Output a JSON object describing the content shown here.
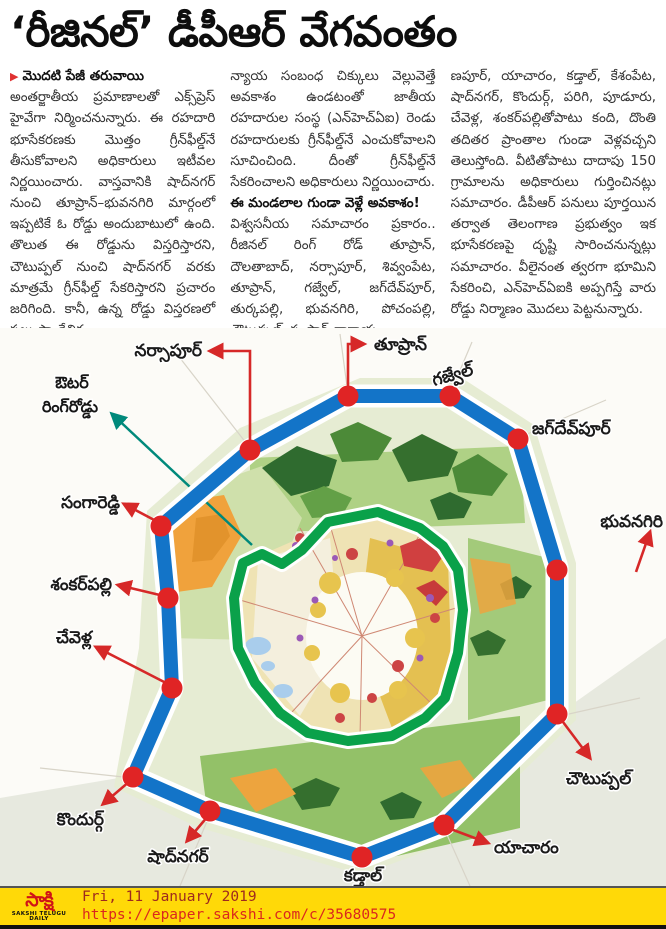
{
  "headline": "‘రీజినల్’ డీపీఆర్ వేగవంతం",
  "article": {
    "continuation_marker": "▶",
    "continuation_label": "మొదటి పేజీ తరువాయి",
    "col1": "అంతర్జాతీయ ప్రమాణాలతో ఎక్స్‌ప్రెస్ హైవేగా నిర్మించనున్నారు. ఈ రహదారి భూసేకరణకు మొత్తం గ్రీన్‌ఫీల్డ్‌నే తీసుకోవాలని అధికారులు ఇటీవల నిర్ణయించారు. వాస్తవానికి షాద్‌నగర్ నుంచి తూప్రాన్‌–భువనగిరి మార్గంలో ఇప్పటికే ఓ రోడ్డు అందుబాటులో ఉంది. తొలుత ఈ రోడ్డును విస్తరిస్తారని, చౌటుప్పల్ నుంచి షాద్‌నగర్ వరకు మాత్రమే గ్రీన్‌ఫీల్డ్ సేకరిస్తారని ప్రచారం జరిగింది. కానీ, ఉన్న రోడ్డు విస్తరణలో పలు సాంకేతిక,",
    "col2_para1": "న్యాయ సంబంధ చిక్కులు వెల్లువెత్తే అవకాశం ఉండటంతో జాతీయ రహదారుల సంస్థ (ఎన్‌హెచ్‌ఏఐ) రెండు రహదారులకు గ్రీన్‌ఫీల్డ్‌నే ఎంచుకోవాలని సూచించింది. దీంతో గ్రీన్‌ఫీల్డ్‌నే సేకరించాలని అధికారులు నిర్ణయించారు.",
    "col2_subhead": "ఈ మండలాల గుండా వెళ్లే అవకాశం!",
    "col2_para2": "విశ్వసనీయ సమాచారం ప్రకారం.. రీజినల్ రింగ్ రోడ్ తూప్రాన్, దౌలతాబాద్, నర్సాపూర్, శివ్వంపేట, తూప్రాన్, గజ్వేల్, జగ్‌దేవ్‌పూర్, తుర్కపల్లి, భువనగిరి, పోచంపల్లి, చౌటుప్పల్, సంస్థాన్ నారాయ",
    "col3": "ణపూర్, యాచారం, కడ్తాల్, కేశంపేట, షాద్‌నగర్, కొందుర్గ్, పరిగి, పూడూరు, చేవెళ్ల, శంకర్‌పల్లితోపాటు కంది, దొంతి తదితర ప్రాంతాల గుండా వెళ్లవచ్చని తెలుస్తోంది. వీటితోపాటు దాదాపు 150 గ్రామాలను అధికారులు గుర్తించినట్లు సమాచారం. డీపీఆర్ పనులు పూర్తయిన తర్వాత తెలంగాణ ప్రభుత్వం ఇక భూసేకరణపై దృష్టి సారించనున్నట్లు సమాచారం. వీలైనంత త్వరగా భూమిని సేకరించి, ఎన్‌హెచ్‌ఏఐకి అప్పగిస్తే వారు రోడ్డు నిర్మాణం మొదలు పెట్టనున్నారు."
  },
  "map": {
    "orr_label": {
      "line1": "ఔటర్",
      "line2": "రింగ్‌రోడ్డు"
    },
    "towns": [
      {
        "id": "narsapur",
        "name": "నర్సాపూర్"
      },
      {
        "id": "toopran",
        "name": "తూప్రాన్"
      },
      {
        "id": "gajwel",
        "name": "గజ్వేల్"
      },
      {
        "id": "jagdevpur",
        "name": "జగ్‌దేవ్‌పూర్"
      },
      {
        "id": "bhuvanagiri",
        "name": "భువనగిరి"
      },
      {
        "id": "choutuppal",
        "name": "చౌటుప్పల్"
      },
      {
        "id": "yacharam",
        "name": "యాచారం"
      },
      {
        "id": "kadthal",
        "name": "కడ్తాల్"
      },
      {
        "id": "shadnagar",
        "name": "షాద్‌నగర్"
      },
      {
        "id": "kondurg",
        "name": "కొందుర్గ్"
      },
      {
        "id": "chevella",
        "name": "చేవెళ్ల"
      },
      {
        "id": "shankarpalli",
        "name": "శంకర్‌పల్లి"
      },
      {
        "id": "sangareddy",
        "name": "సంగారెడ్డి"
      }
    ]
  },
  "footer": {
    "logo_text": "సాక్షి",
    "logo_tagline": "SAKSHI TELUGU DAILY",
    "date": "Fri, 11 January 2019",
    "url": "https://epaper.sakshi.com/c/35680575"
  },
  "colors": {
    "ring_blue": "#1374c8",
    "orr_green": "#0aa14a",
    "marker_red": "#e02425",
    "arrow_red": "#d62828",
    "pointer_teal": "#00897b",
    "footer_yellow": "#ffd908",
    "accent_red": "#e03131"
  }
}
